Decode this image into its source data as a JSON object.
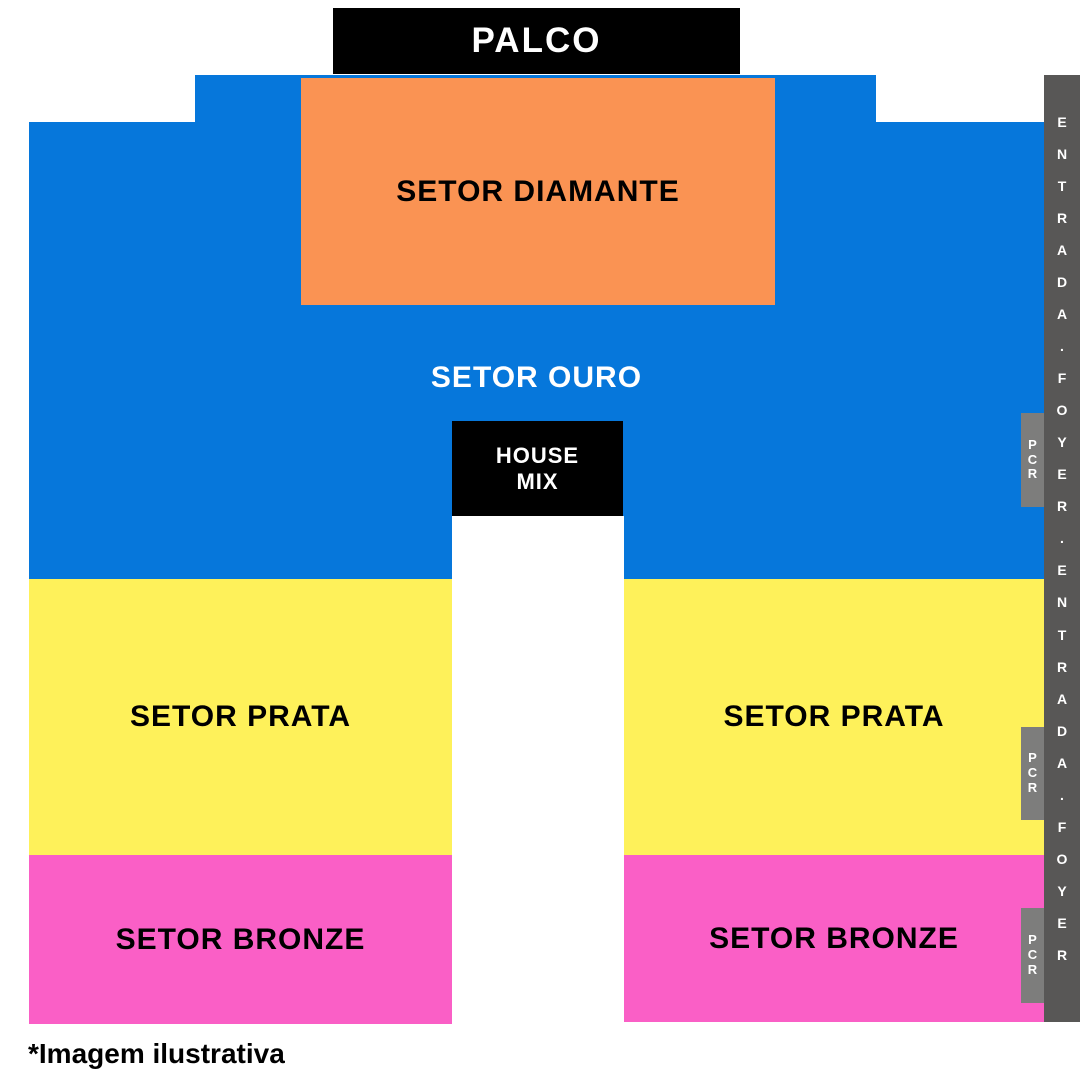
{
  "stage": {
    "label": "PALCO",
    "bg": "#000000",
    "fg": "#ffffff"
  },
  "sectors": {
    "diamante": {
      "label": "SETOR DIAMANTE",
      "color": "#FA9353"
    },
    "ouro": {
      "label": "SETOR OURO",
      "color": "#0677DB"
    },
    "prata_left": {
      "label": "SETOR PRATA",
      "color": "#FEF15A"
    },
    "prata_right": {
      "label": "SETOR PRATA",
      "color": "#FEF15A"
    },
    "bronze_left": {
      "label": "SETOR BRONZE",
      "color": "#FA5FC6"
    },
    "bronze_right": {
      "label": "SETOR BRONZE",
      "color": "#FA5FC6"
    }
  },
  "house_mix": {
    "line1": "HOUSE",
    "line2": "MIX",
    "bg": "#000000"
  },
  "entrance_bar": {
    "text": "ENTRADA.FOYER.ENTRADA.FOYER",
    "bg": "#585756"
  },
  "pcr": {
    "label": "PCR",
    "bg": "#7D7D7C"
  },
  "footnote": "*Imagem ilustrativa"
}
